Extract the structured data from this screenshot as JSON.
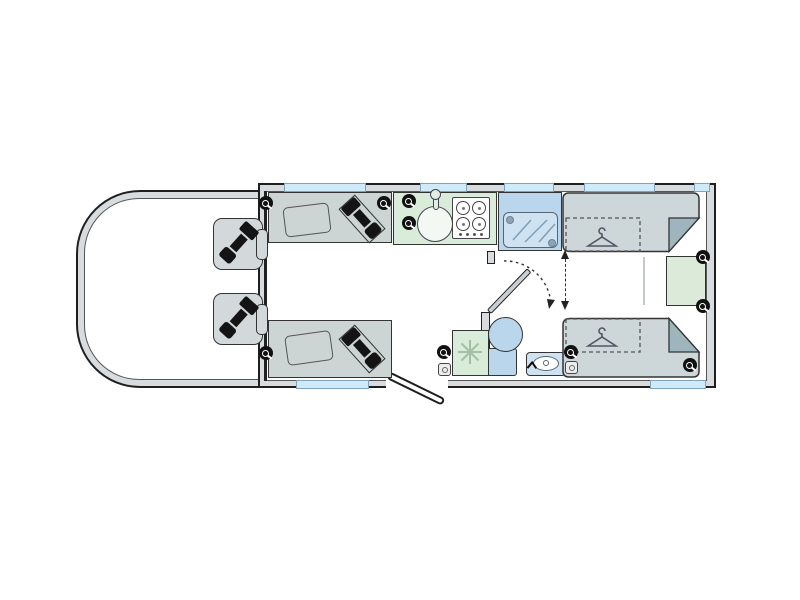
{
  "diagram_type": "motorhome-floorplan",
  "colors": {
    "outline": "#1f1f1f",
    "wall": "#d8dcdf",
    "floor": "#ffffff",
    "furniture": "#ccd5d3",
    "seat": "#d3d9db",
    "bed": "#cdd6d8",
    "fold": "#9fb5bd",
    "kitchen": "#d9ecd9",
    "cabinet": "#dcead9",
    "shower": "#b9d6ec",
    "glass": "#cfe2f1",
    "window": "#cfeaf9",
    "belt": "#141414",
    "accent_dark": "#111111"
  },
  "features": {
    "cab_seats": 2,
    "cab_seatbelts": 2,
    "lounge_sofas": 2,
    "sofa_cushions": 2,
    "travel_seatbelts": 2,
    "kitchen": {
      "sink": 1,
      "tap": 1,
      "hob_burners": 4,
      "fridge": 1
    },
    "washroom": {
      "shower": 1,
      "toilet": 1,
      "washbasin": 1,
      "swing_door": 1
    },
    "rear_single_beds": 2,
    "wardrobe_hanger_symbols": 2,
    "blanket_folds": 2,
    "rear_cabinet": 1,
    "speakers": 10,
    "sockets": 2,
    "windows": 7,
    "entrance_door": 1,
    "bed_slide_indicator": 1
  }
}
